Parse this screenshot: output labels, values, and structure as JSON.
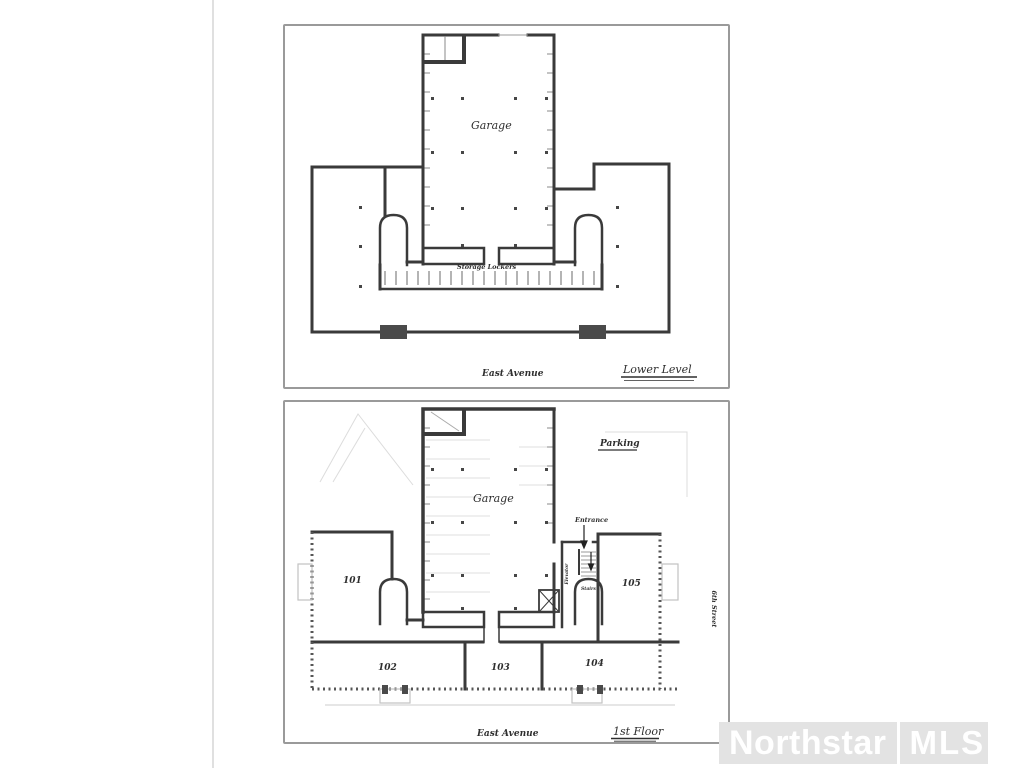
{
  "colors": {
    "ink": "#3a3a3a",
    "faint": "#c9c9c9",
    "frame_border": "#9a9a9a",
    "watermark_bg": "#e3e3e3",
    "watermark_text": "#ffffff"
  },
  "plans": {
    "lower_level": {
      "garage_label": "Garage",
      "storage_label": "Storage Lockers",
      "street_label": "East Avenue",
      "title": "Lower Level"
    },
    "first_floor": {
      "garage_label": "Garage",
      "parking_label": "Parking",
      "entrance_label": "Entrance",
      "elevator_label": "Elevator",
      "stairs_label": "Stairs",
      "street_bottom_label": "East Avenue",
      "street_right_label": "6th Street",
      "title": "1st Floor",
      "units": {
        "u101": "101",
        "u102": "102",
        "u103": "103",
        "u104": "104",
        "u105": "105"
      }
    }
  },
  "watermark": {
    "brand": "Northstar",
    "org": "MLS"
  }
}
